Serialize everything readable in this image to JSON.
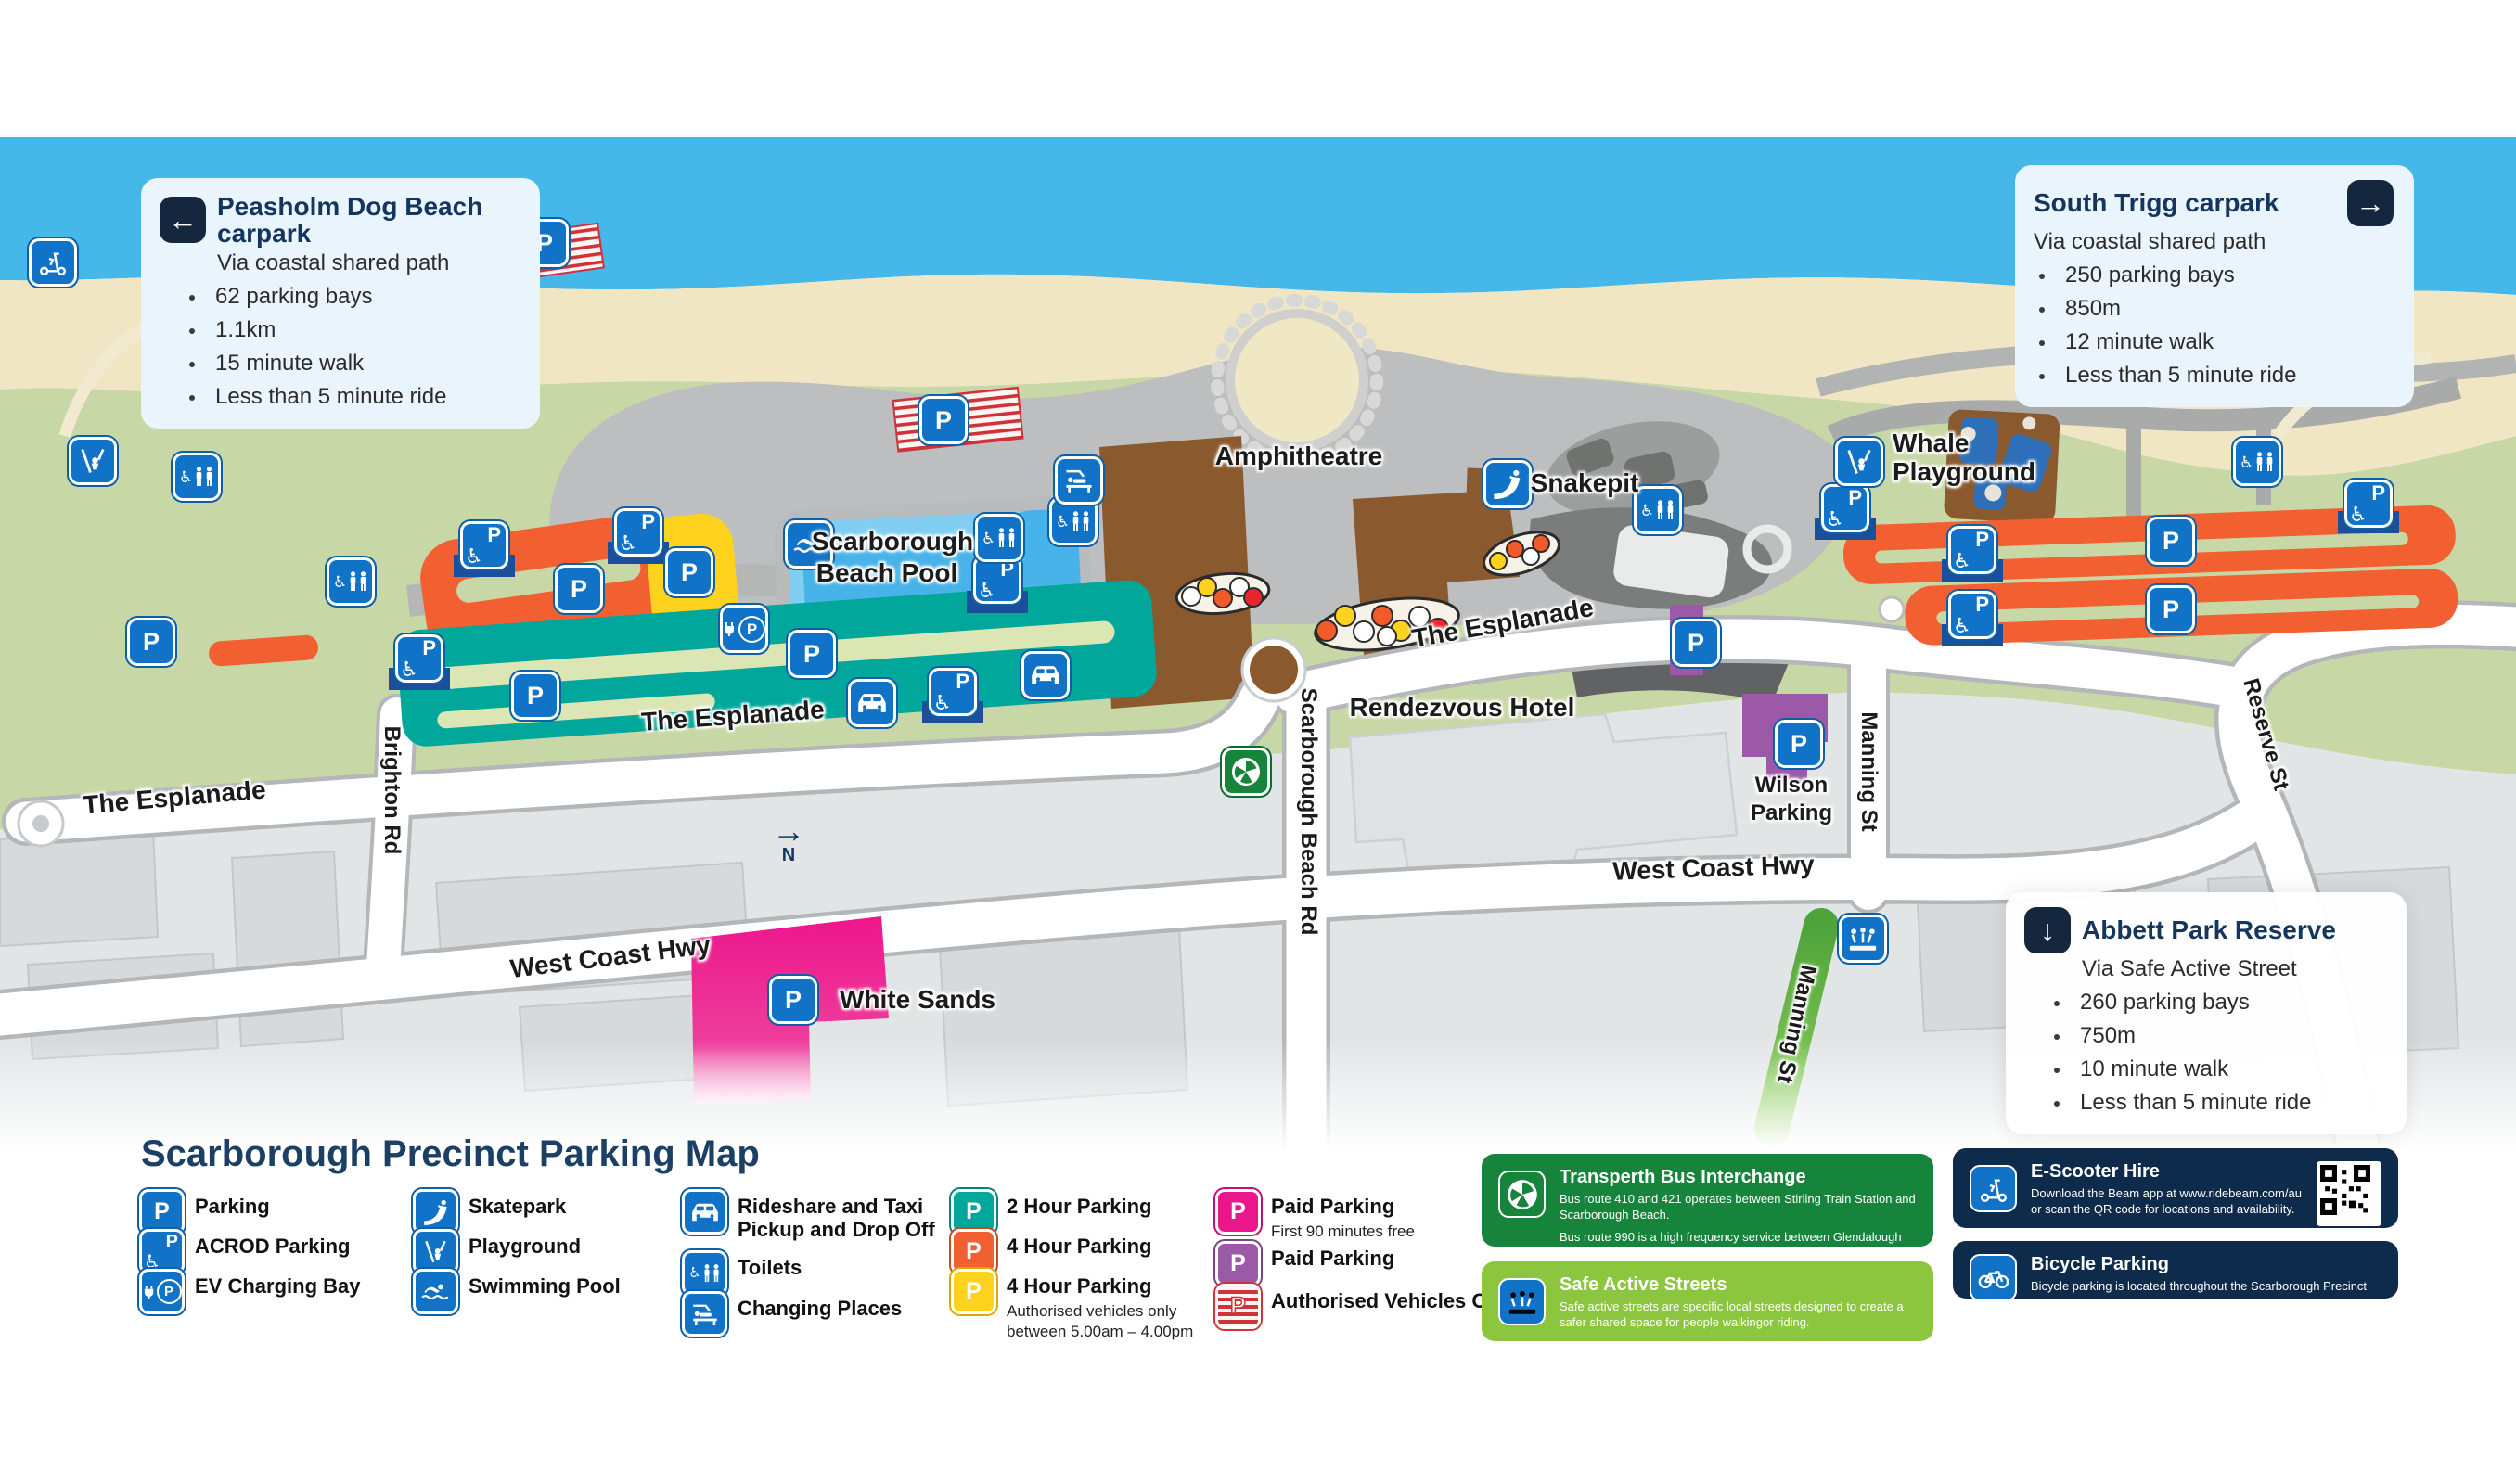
{
  "glyphs": {
    "parking": "P",
    "wheelchair": "♿",
    "arrow_left": "←",
    "arrow_right": "→",
    "arrow_down": "↓",
    "north_arrow": "→",
    "north": "N"
  },
  "map": {
    "labels": {
      "esplanade_left": "The Esplanade",
      "esplanade_teal": "The Esplanade",
      "esplanade_right": "The Esplanade",
      "brighton_rd": "Brighton Rd",
      "scarborough_beach_rd": "Scarborough Beach Rd",
      "west_coast_hwy_left": "West Coast Hwy",
      "west_coast_hwy_right": "West Coast Hwy",
      "manning_st_road": "Manning St",
      "manning_st_safe": "Manning St",
      "reserve_st": "Reserve St",
      "amphitheatre": "Amphitheatre",
      "snakepit": "Snakepit",
      "whale_line1": "Whale",
      "whale_line2": "Playground",
      "pool_line1": "Scarborough",
      "pool_line2": "Beach Pool",
      "rendezvous_hotel": "Rendezvous Hotel",
      "wilson_line1": "Wilson",
      "wilson_line2": "Parking",
      "white_sands": "White Sands"
    },
    "info_boxes": {
      "peasholm": {
        "title": "Peasholm Dog Beach carpark",
        "subtitle": "Via coastal shared path",
        "bullet1": "62 parking bays",
        "bullet2": "1.1km",
        "bullet3": "15 minute walk",
        "bullet4": "Less than 5 minute ride"
      },
      "south_trigg": {
        "title": "South Trigg carpark",
        "subtitle": "Via coastal shared path",
        "bullet1": "250 parking bays",
        "bullet2": "850m",
        "bullet3": "12 minute walk",
        "bullet4": "Less than 5 minute ride"
      },
      "abbett_park": {
        "title": "Abbett Park Reserve",
        "subtitle": "Via Safe Active Street",
        "bullet1": "260 parking bays",
        "bullet2": "750m",
        "bullet3": "10 minute walk",
        "bullet4": "Less than 5 minute ride"
      }
    }
  },
  "legend": {
    "title": "Scarborough Precinct Parking Map",
    "parking": "Parking",
    "acrod": "ACROD Parking",
    "ev": "EV Charging Bay",
    "skatepark": "Skatepark",
    "playground": "Playground",
    "swimming_pool": "Swimming Pool",
    "rideshare_line1": "Rideshare and Taxi",
    "rideshare_line2": "Pickup and Drop Off",
    "toilets": "Toilets",
    "changing_places": "Changing Places",
    "two_hour": "2 Hour Parking",
    "four_hour": "4 Hour Parking",
    "four_hour_yellow": "4 Hour Parking",
    "four_hour_note1": "Authorised vehicles only",
    "four_hour_note2": "between 5.00am – 4.00pm",
    "paid_pink": "Paid Parking",
    "paid_pink_note": "First 90 minutes free",
    "paid_purple": "Paid Parking",
    "authorised": "Authorised Vehicles Only"
  },
  "panels": {
    "transperth": {
      "title": "Transperth Bus Interchange",
      "body1": "Bus route 410 and 421 operates between Stirling Train Station and Scarborough Beach.",
      "body2": "Bus route 990 is a high frequency service between Glendalough Train Station and Scarborough Beach."
    },
    "safe_active": {
      "title": "Safe Active Streets",
      "body1": "Safe active streets are specific local streets designed to create a safer shared space for people walkingor riding."
    },
    "escooter": {
      "title": "E-Scooter Hire",
      "body1": "Download the Beam app at www.ridebeam.com/au or scan the QR code for locations and availability."
    },
    "bicycle": {
      "title": "Bicycle Parking",
      "body1": "Bicycle parking is located throughout the Scarborough Precinct"
    }
  },
  "colors": {
    "parking_blue": "#1173c8",
    "two_hour_teal": "#00a79b",
    "four_hour_orange": "#f25f31",
    "four_hour_yellow": "#ffd21e",
    "paid_pink": "#ec168c",
    "paid_purple": "#9b59a8",
    "authorised_red": "#cf3339",
    "transperth_green": "#17843c",
    "safe_green": "#8cc63f",
    "navy": "#0e2b4c"
  }
}
